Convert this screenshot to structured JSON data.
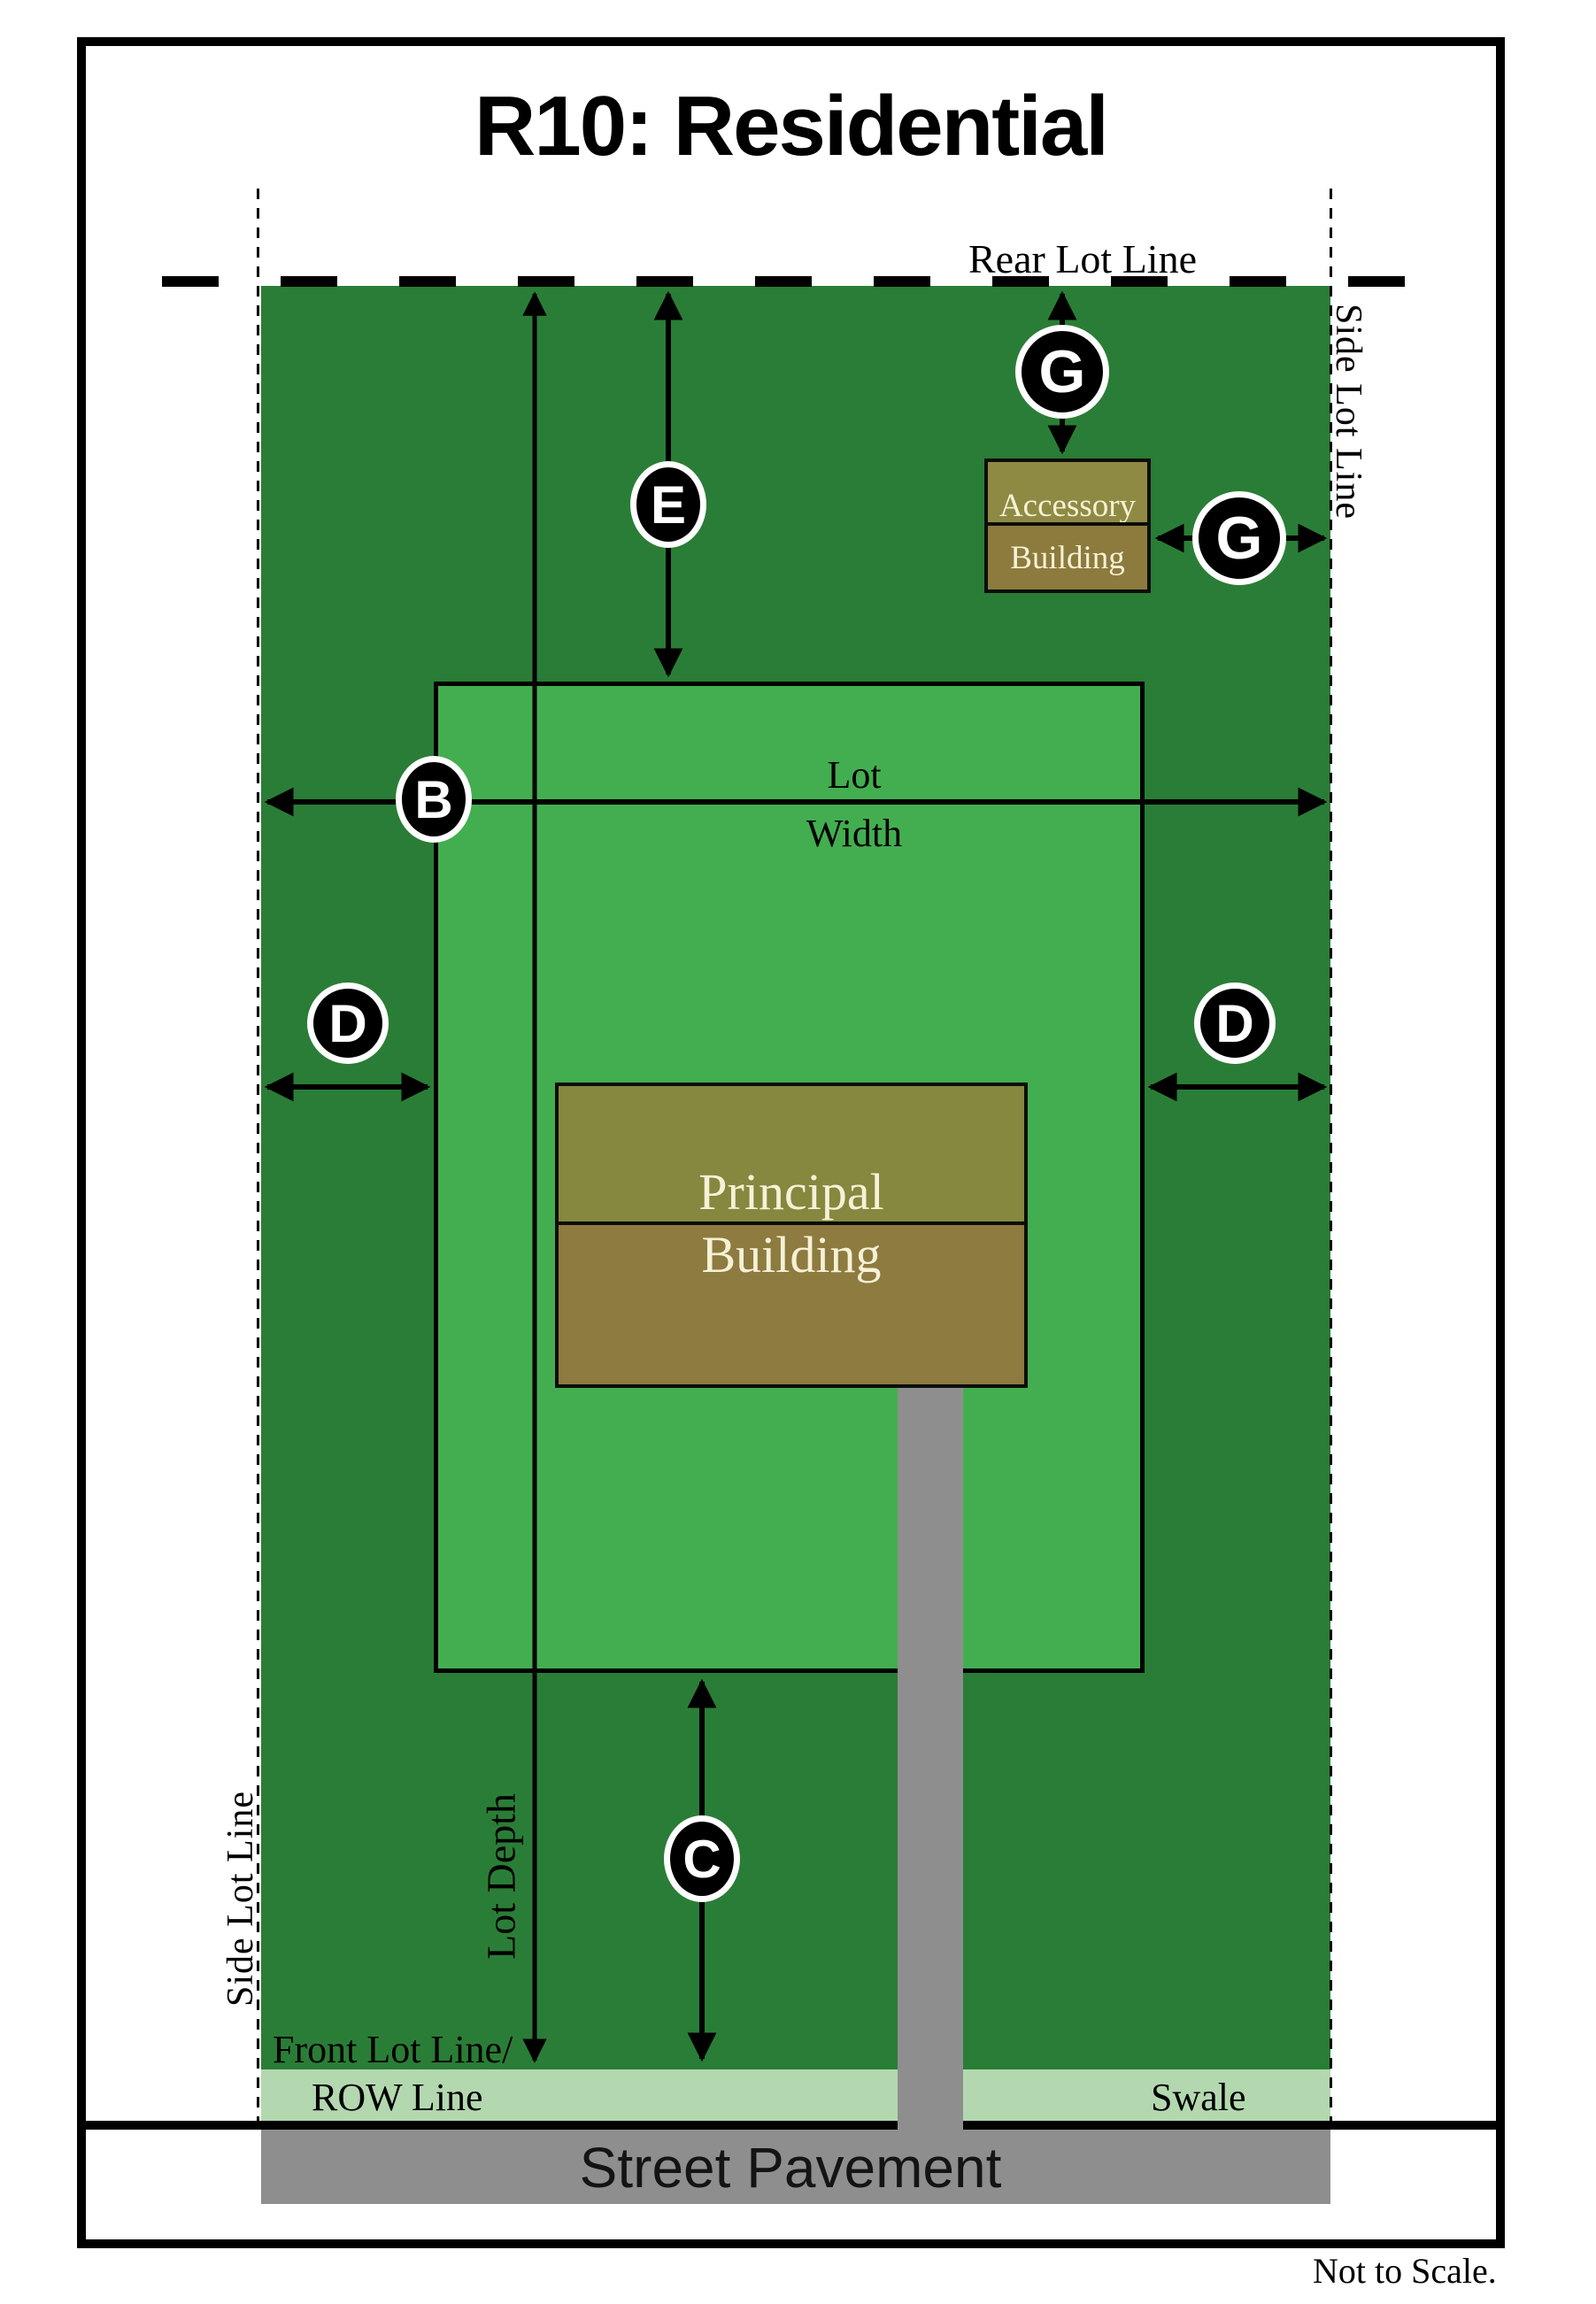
{
  "title": "R10: Residential",
  "footnote": "Not to Scale.",
  "labels": {
    "rear_lot_line": "Rear Lot Line",
    "side_lot_line_right": "Side Lot Line",
    "side_lot_line_left": "Side Lot Line",
    "lot_width_line1": "Lot",
    "lot_width_line2": "Width",
    "lot_depth": "Lot Depth",
    "front_lot_line": "Front Lot Line/",
    "row_line": "ROW Line",
    "swale": "Swale",
    "street_pavement": "Street Pavement"
  },
  "buildings": {
    "principal_line1": "Principal",
    "principal_line2": "Building",
    "accessory_line1": "Accessory",
    "accessory_line2": "Building"
  },
  "badges": {
    "b": "B",
    "c": "C",
    "d_left": "D",
    "d_right": "D",
    "e": "E",
    "g_top": "G",
    "g_side": "G"
  },
  "colors": {
    "lot-green": "#2a7d36",
    "buildable-green": "#43ae50",
    "building-top": "#85883e",
    "building-bottom": "#8d7b3f",
    "accessory-top": "#8f8a43",
    "accessory-bottom": "#8d7b3e",
    "swale-green": "#b3d8b0",
    "pavement-gray": "#8e8e8e",
    "building-text": "#f6f1d7",
    "ink": "#000000"
  }
}
